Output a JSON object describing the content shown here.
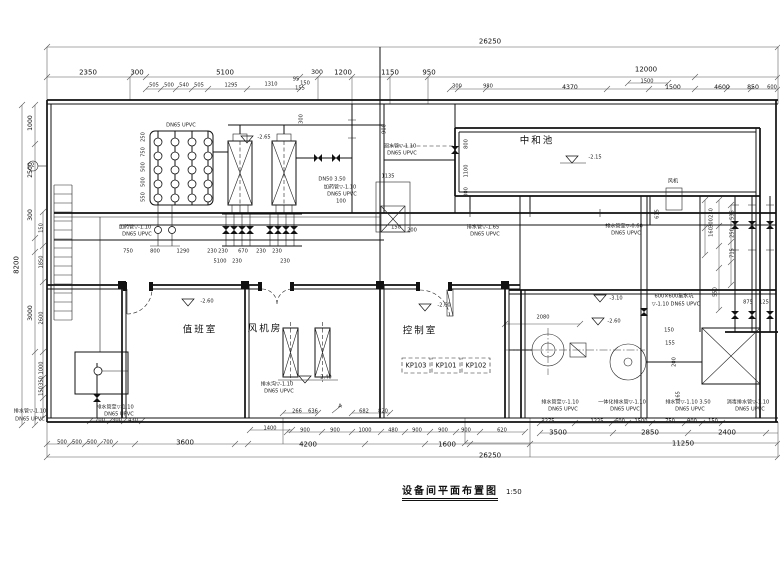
{
  "title_block": {
    "title": "设备间平面布置图",
    "scale": "1:50"
  },
  "colors": {
    "ink": "#111111",
    "paper": "#ffffff"
  },
  "annotations": [
    {
      "x": 490,
      "y": 42,
      "text": "26250",
      "cls": "md"
    },
    {
      "x": 88,
      "y": 73,
      "text": "2350",
      "cls": "md"
    },
    {
      "x": 137,
      "y": 73,
      "text": "300",
      "cls": "md"
    },
    {
      "x": 225,
      "y": 73,
      "text": "5100",
      "cls": "md"
    },
    {
      "x": 317,
      "y": 73,
      "text": "300"
    },
    {
      "x": 343,
      "y": 73,
      "text": "1200",
      "cls": "md"
    },
    {
      "x": 390,
      "y": 73,
      "text": "1150",
      "cls": "md"
    },
    {
      "x": 429,
      "y": 73,
      "text": "950",
      "cls": "md"
    },
    {
      "x": 646,
      "y": 70,
      "text": "12000",
      "cls": "md"
    },
    {
      "x": 154,
      "y": 86,
      "text": "505",
      "cls": "xs"
    },
    {
      "x": 169,
      "y": 86,
      "text": "500",
      "cls": "xs"
    },
    {
      "x": 184,
      "y": 86,
      "text": "540",
      "cls": "xs"
    },
    {
      "x": 199,
      "y": 86,
      "text": "505",
      "cls": "xs"
    },
    {
      "x": 231,
      "y": 86,
      "text": "1295",
      "cls": "xs"
    },
    {
      "x": 271,
      "y": 85,
      "text": "1310",
      "cls": "xs"
    },
    {
      "x": 296,
      "y": 80,
      "text": "95",
      "cls": "xs"
    },
    {
      "x": 305,
      "y": 84,
      "text": "150",
      "cls": "xs"
    },
    {
      "x": 300,
      "y": 89,
      "text": "155",
      "cls": "xs"
    },
    {
      "x": 457,
      "y": 87,
      "text": "300",
      "cls": "xs"
    },
    {
      "x": 488,
      "y": 87,
      "text": "980",
      "cls": "xs"
    },
    {
      "x": 570,
      "y": 88,
      "text": "4370"
    },
    {
      "x": 647,
      "y": 82,
      "text": "1500",
      "cls": "xs"
    },
    {
      "x": 673,
      "y": 88,
      "text": "1500"
    },
    {
      "x": 722,
      "y": 88,
      "text": "4600"
    },
    {
      "x": 753,
      "y": 88,
      "text": "850"
    },
    {
      "x": 772,
      "y": 88,
      "text": "600",
      "cls": "xs"
    },
    {
      "x": 17,
      "y": 265,
      "text": "8200",
      "cls": "md",
      "rot": 1
    },
    {
      "x": 31,
      "y": 123,
      "text": "1000",
      "rot": 1
    },
    {
      "x": 31,
      "y": 170,
      "text": "2500",
      "rot": 1
    },
    {
      "x": 31,
      "y": 215,
      "text": "300",
      "rot": 1
    },
    {
      "x": 31,
      "y": 313,
      "text": "3000",
      "rot": 1
    },
    {
      "x": 42,
      "y": 228,
      "text": "150",
      "cls": "xs",
      "rot": 1
    },
    {
      "x": 42,
      "y": 262,
      "text": "1850",
      "cls": "xs",
      "rot": 1
    },
    {
      "x": 42,
      "y": 318,
      "text": "2600",
      "cls": "xs",
      "rot": 1
    },
    {
      "x": 42,
      "y": 368,
      "text": "1000",
      "cls": "xs",
      "rot": 1
    },
    {
      "x": 42,
      "y": 381,
      "text": "350",
      "cls": "xs",
      "rot": 1
    },
    {
      "x": 42,
      "y": 391,
      "text": "150",
      "cls": "xs",
      "rot": 1
    },
    {
      "x": 144,
      "y": 137,
      "text": "250",
      "cls": "xs",
      "rot": 1
    },
    {
      "x": 144,
      "y": 152,
      "text": "750",
      "cls": "xs",
      "rot": 1
    },
    {
      "x": 144,
      "y": 167,
      "text": "500",
      "cls": "xs",
      "rot": 1
    },
    {
      "x": 144,
      "y": 182,
      "text": "500",
      "cls": "xs",
      "rot": 1
    },
    {
      "x": 144,
      "y": 197,
      "text": "550",
      "cls": "xs",
      "rot": 1
    },
    {
      "x": 181,
      "y": 126,
      "text": "DN65 UPVC",
      "cls": "xs",
      "name": "pipe-label"
    },
    {
      "x": 264,
      "y": 138,
      "text": "-2.65",
      "cls": "xs",
      "name": "level-label"
    },
    {
      "x": 302,
      "y": 119,
      "text": "300",
      "cls": "xs",
      "rot": 1
    },
    {
      "x": 385,
      "y": 129,
      "text": "900",
      "cls": "xs",
      "rot": 1
    },
    {
      "x": 332,
      "y": 180,
      "text": "DN50 3.50",
      "cls": "xs",
      "name": "pipe-label"
    },
    {
      "x": 340,
      "y": 188,
      "text": "加药管▽-1.10",
      "cls": "xs",
      "name": "pipe-label"
    },
    {
      "x": 342,
      "y": 195,
      "text": "DN65 UPVC",
      "cls": "xs",
      "name": "pipe-label"
    },
    {
      "x": 341,
      "y": 202,
      "text": "100",
      "cls": "xs"
    },
    {
      "x": 388,
      "y": 177,
      "text": "1135",
      "cls": "xs"
    },
    {
      "x": 396,
      "y": 228,
      "text": "150",
      "cls": "xs"
    },
    {
      "x": 412,
      "y": 231,
      "text": "200",
      "cls": "xs"
    },
    {
      "x": 400,
      "y": 147,
      "text": "回水管▽-1.10",
      "cls": "xs",
      "name": "pipe-label"
    },
    {
      "x": 402,
      "y": 154,
      "text": "DN65 UPVC",
      "cls": "xs",
      "name": "pipe-label"
    },
    {
      "x": 135,
      "y": 228,
      "text": "加药管▽-1.10",
      "cls": "xs",
      "name": "pipe-label"
    },
    {
      "x": 137,
      "y": 235,
      "text": "DN65 UPVC",
      "cls": "xs",
      "name": "pipe-label"
    },
    {
      "x": 128,
      "y": 252,
      "text": "750",
      "cls": "xs"
    },
    {
      "x": 155,
      "y": 252,
      "text": "800",
      "cls": "xs"
    },
    {
      "x": 183,
      "y": 252,
      "text": "1290",
      "cls": "xs"
    },
    {
      "x": 212,
      "y": 252,
      "text": "230",
      "cls": "xs"
    },
    {
      "x": 223,
      "y": 252,
      "text": "230",
      "cls": "xs"
    },
    {
      "x": 243,
      "y": 252,
      "text": "670",
      "cls": "xs"
    },
    {
      "x": 261,
      "y": 252,
      "text": "230",
      "cls": "xs"
    },
    {
      "x": 277,
      "y": 252,
      "text": "230",
      "cls": "xs"
    },
    {
      "x": 220,
      "y": 262,
      "text": "5100",
      "cls": "xs"
    },
    {
      "x": 237,
      "y": 262,
      "text": "230",
      "cls": "xs"
    },
    {
      "x": 285,
      "y": 262,
      "text": "230",
      "cls": "xs"
    },
    {
      "x": 537,
      "y": 141,
      "text": "中和池",
      "cls": "room",
      "name": "room-label"
    },
    {
      "x": 595,
      "y": 158,
      "text": "-2.15",
      "cls": "xs",
      "name": "level-label"
    },
    {
      "x": 467,
      "y": 144,
      "text": "800",
      "cls": "xs",
      "rot": 1
    },
    {
      "x": 467,
      "y": 171,
      "text": "1100",
      "cls": "xs",
      "rot": 1
    },
    {
      "x": 467,
      "y": 192,
      "text": "300",
      "cls": "xs",
      "rot": 1
    },
    {
      "x": 483,
      "y": 228,
      "text": "排水管▽-1.65",
      "cls": "xs",
      "name": "pipe-label"
    },
    {
      "x": 485,
      "y": 235,
      "text": "DN65 UPVC",
      "cls": "xs",
      "name": "pipe-label"
    },
    {
      "x": 624,
      "y": 227,
      "text": "排水管至▽-0.60",
      "cls": "xs",
      "name": "pipe-label"
    },
    {
      "x": 626,
      "y": 234,
      "text": "DN65 UPVC",
      "cls": "xs",
      "name": "pipe-label"
    },
    {
      "x": 673,
      "y": 182,
      "text": "风机",
      "cls": "xs",
      "name": "equipment-label"
    },
    {
      "x": 658,
      "y": 214,
      "text": "615",
      "cls": "xs",
      "rot": 1
    },
    {
      "x": 712,
      "y": 213,
      "text": "230",
      "cls": "xs",
      "rot": 1
    },
    {
      "x": 712,
      "y": 223,
      "text": "300",
      "cls": "xs",
      "rot": 1
    },
    {
      "x": 712,
      "y": 232,
      "text": "160",
      "cls": "xs",
      "rot": 1
    },
    {
      "x": 733,
      "y": 215,
      "text": "535",
      "cls": "xs",
      "rot": 1
    },
    {
      "x": 733,
      "y": 233,
      "text": "250",
      "cls": "xs",
      "rot": 1
    },
    {
      "x": 733,
      "y": 253,
      "text": "715",
      "cls": "xs",
      "rot": 1
    },
    {
      "x": 716,
      "y": 292,
      "text": "550",
      "cls": "xs",
      "rot": 1
    },
    {
      "x": 748,
      "y": 303,
      "text": "875",
      "cls": "xs"
    },
    {
      "x": 764,
      "y": 303,
      "text": "125",
      "cls": "xs"
    },
    {
      "x": 674,
      "y": 297,
      "text": "600×600集水坑",
      "cls": "xs",
      "name": "pipe-label"
    },
    {
      "x": 676,
      "y": 305,
      "text": "▽-1.10 DN65 UPVC",
      "cls": "xs",
      "name": "pipe-label"
    },
    {
      "x": 616,
      "y": 299,
      "text": "-3.10",
      "cls": "xs",
      "name": "level-label"
    },
    {
      "x": 614,
      "y": 322,
      "text": "-2.60",
      "cls": "xs",
      "name": "level-label"
    },
    {
      "x": 543,
      "y": 318,
      "text": "2080",
      "cls": "xs"
    },
    {
      "x": 669,
      "y": 331,
      "text": "150",
      "cls": "xs"
    },
    {
      "x": 670,
      "y": 344,
      "text": "155",
      "cls": "xs"
    },
    {
      "x": 675,
      "y": 362,
      "text": "200",
      "cls": "xs",
      "rot": 1
    },
    {
      "x": 679,
      "y": 396,
      "text": "165",
      "cls": "xs",
      "rot": 1
    },
    {
      "x": 200,
      "y": 330,
      "text": "值班室",
      "cls": "room",
      "name": "room-label"
    },
    {
      "x": 265,
      "y": 329,
      "text": "风机房",
      "cls": "room",
      "name": "room-label"
    },
    {
      "x": 420,
      "y": 331,
      "text": "控制室",
      "cls": "room",
      "name": "room-label"
    },
    {
      "x": 207,
      "y": 302,
      "text": "-2.60",
      "cls": "xs",
      "name": "level-label"
    },
    {
      "x": 444,
      "y": 306,
      "text": "-2.60",
      "cls": "xs",
      "name": "level-label"
    },
    {
      "x": 325,
      "y": 378,
      "text": "-2.40",
      "cls": "xs",
      "name": "level-label"
    },
    {
      "x": 416,
      "y": 366,
      "text": "KP103",
      "cls": "tag",
      "name": "panel-tag"
    },
    {
      "x": 446,
      "y": 366,
      "text": "KP101",
      "cls": "tag",
      "name": "panel-tag"
    },
    {
      "x": 476,
      "y": 366,
      "text": "KP102",
      "cls": "tag",
      "name": "panel-tag"
    },
    {
      "x": 277,
      "y": 385,
      "text": "排水沟▽-1.10",
      "cls": "xs",
      "name": "pipe-label"
    },
    {
      "x": 279,
      "y": 392,
      "text": "DN65 UPVC",
      "cls": "xs",
      "name": "pipe-label"
    },
    {
      "x": 115,
      "y": 408,
      "text": "排水管至▽-1.10",
      "cls": "xs",
      "name": "pipe-label"
    },
    {
      "x": 119,
      "y": 415,
      "text": "DN65 UPVC",
      "cls": "xs",
      "name": "pipe-label"
    },
    {
      "x": 30,
      "y": 412,
      "text": "排水管▽-1.10",
      "cls": "xs",
      "name": "pipe-label"
    },
    {
      "x": 30,
      "y": 420,
      "text": "DN65 UPVC",
      "cls": "xs",
      "name": "pipe-label"
    },
    {
      "x": 100,
      "y": 421,
      "text": "700",
      "cls": "xs"
    },
    {
      "x": 117,
      "y": 421,
      "text": "300",
      "cls": "xs"
    },
    {
      "x": 133,
      "y": 421,
      "text": "430",
      "cls": "xs"
    },
    {
      "x": 62,
      "y": 443,
      "text": "500",
      "cls": "xs"
    },
    {
      "x": 77,
      "y": 443,
      "text": "500",
      "cls": "xs"
    },
    {
      "x": 92,
      "y": 443,
      "text": "500",
      "cls": "xs"
    },
    {
      "x": 108,
      "y": 443,
      "text": "700",
      "cls": "xs"
    },
    {
      "x": 185,
      "y": 443,
      "text": "3600",
      "cls": "md"
    },
    {
      "x": 270,
      "y": 429,
      "text": "1400",
      "cls": "xs"
    },
    {
      "x": 308,
      "y": 445,
      "text": "4200",
      "cls": "md"
    },
    {
      "x": 447,
      "y": 445,
      "text": "1600",
      "cls": "md"
    },
    {
      "x": 297,
      "y": 412,
      "text": "266",
      "cls": "xs"
    },
    {
      "x": 313,
      "y": 412,
      "text": "636",
      "cls": "xs"
    },
    {
      "x": 364,
      "y": 412,
      "text": "682",
      "cls": "xs"
    },
    {
      "x": 383,
      "y": 412,
      "text": "820",
      "cls": "xs"
    },
    {
      "x": 340,
      "y": 407,
      "text": "A",
      "cls": "xs",
      "name": "section-marker-label"
    },
    {
      "x": 305,
      "y": 431,
      "text": "900",
      "cls": "xs"
    },
    {
      "x": 335,
      "y": 431,
      "text": "900",
      "cls": "xs"
    },
    {
      "x": 365,
      "y": 431,
      "text": "1000",
      "cls": "xs"
    },
    {
      "x": 393,
      "y": 431,
      "text": "480",
      "cls": "xs"
    },
    {
      "x": 417,
      "y": 431,
      "text": "900",
      "cls": "xs"
    },
    {
      "x": 443,
      "y": 431,
      "text": "900",
      "cls": "xs"
    },
    {
      "x": 466,
      "y": 431,
      "text": "900",
      "cls": "xs"
    },
    {
      "x": 502,
      "y": 431,
      "text": "620",
      "cls": "xs"
    },
    {
      "x": 548,
      "y": 422,
      "text": "2275",
      "cls": "xs"
    },
    {
      "x": 597,
      "y": 422,
      "text": "1225",
      "cls": "xs"
    },
    {
      "x": 620,
      "y": 422,
      "text": "600",
      "cls": "xs"
    },
    {
      "x": 641,
      "y": 422,
      "text": "1500",
      "cls": "xs"
    },
    {
      "x": 670,
      "y": 422,
      "text": "750",
      "cls": "xs"
    },
    {
      "x": 692,
      "y": 422,
      "text": "900",
      "cls": "xs"
    },
    {
      "x": 713,
      "y": 422,
      "text": "150",
      "cls": "xs"
    },
    {
      "x": 558,
      "y": 433,
      "text": "3500",
      "cls": "md"
    },
    {
      "x": 650,
      "y": 433,
      "text": "2850",
      "cls": "md"
    },
    {
      "x": 727,
      "y": 433,
      "text": "2400",
      "cls": "md"
    },
    {
      "x": 683,
      "y": 444,
      "text": "11250",
      "cls": "md"
    },
    {
      "x": 490,
      "y": 456,
      "text": "26250",
      "cls": "md"
    },
    {
      "x": 560,
      "y": 403,
      "text": "排水管至▽-1.10",
      "cls": "xs",
      "name": "pipe-label"
    },
    {
      "x": 563,
      "y": 410,
      "text": "DN65 UPVC",
      "cls": "xs",
      "name": "pipe-label"
    },
    {
      "x": 622,
      "y": 403,
      "text": "一体化排水管▽-1.10",
      "cls": "xs",
      "name": "pipe-label"
    },
    {
      "x": 625,
      "y": 410,
      "text": "DN65 UPVC",
      "cls": "xs",
      "name": "pipe-label"
    },
    {
      "x": 688,
      "y": 403,
      "text": "排水管▽-1.10 3.50",
      "cls": "xs",
      "name": "pipe-label"
    },
    {
      "x": 690,
      "y": 410,
      "text": "DN65 UPVC",
      "cls": "xs",
      "name": "pipe-label"
    },
    {
      "x": 748,
      "y": 403,
      "text": "消毒排水管▽-1.10",
      "cls": "xs",
      "name": "pipe-label"
    },
    {
      "x": 750,
      "y": 410,
      "text": "DN65 UPVC",
      "cls": "xs",
      "name": "pipe-label"
    },
    {
      "x": 33,
      "y": 166,
      "text": "2",
      "cls": "xs",
      "name": "section-marker-label"
    }
  ]
}
